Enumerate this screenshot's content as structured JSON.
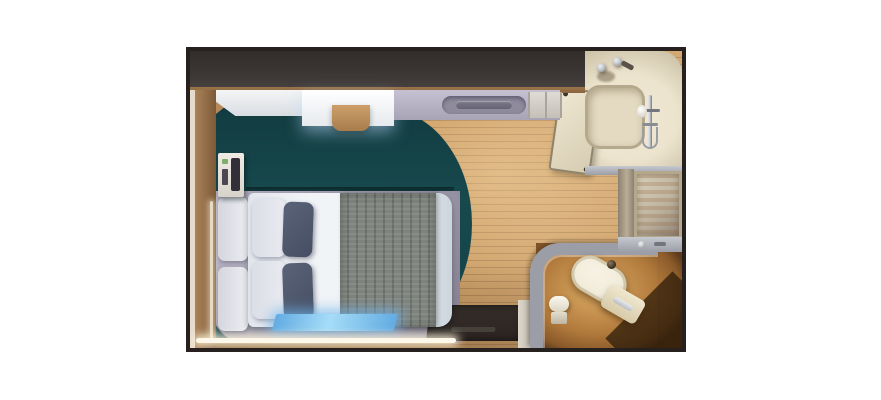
{
  "scene": {
    "type": "cruise-cabin-floorplan-render",
    "view": "top-down-3d",
    "rooms": [
      {
        "name": "bedroom",
        "items": [
          "overhead-shelf",
          "vanity-desk",
          "desk-stool",
          "overhead-cabinet",
          "wall-phone-panel",
          "teal-carpet",
          "bed-platform",
          "headboard",
          "bed-duvet",
          "bed-throw",
          "pillow-white-1",
          "pillow-white-2",
          "pillow-dark-1",
          "pillow-dark-2",
          "foot-bench",
          "led-strip-bottom",
          "led-strip-left"
        ]
      },
      {
        "name": "corridor",
        "items": [
          "wood-floor",
          "entrance-mat",
          "entry-wall"
        ]
      },
      {
        "name": "bathroom",
        "items": [
          "sink-faucets",
          "shower-tray",
          "shower-bar",
          "shower-knob",
          "bathroom-vanity-unit",
          "bath-ledge"
        ]
      },
      {
        "name": "wet-area",
        "items": [
          "vanity-divider",
          "mirror-cabinet",
          "vanity-counter"
        ]
      },
      {
        "name": "toilet-room",
        "items": [
          "toilet-room-wall",
          "toilet-seat",
          "toilet-tank",
          "flush-knob",
          "toilet-paper-roll",
          "toilet-paper-holder"
        ]
      }
    ]
  },
  "colors": {
    "background": "#ffffff",
    "frame": "#26211f",
    "top_wall": "#3b3533",
    "wood_mid": "#c9995f",
    "wood_line": "#a97c4b",
    "wall_wood": "#9a7448",
    "carpet_teal": "#17494d",
    "carpet_teal_dark": "#123c41",
    "platform": "#b6b1c3",
    "platform_dark": "#8e899b",
    "duvet": "#f1f4f7",
    "duvet_shadow": "#ccd5dd",
    "throw_gray": "#7f837d",
    "throw_stripe": "#6a6e68",
    "pillow_white": "#e9ebf1",
    "pillow_dark": "#525b71",
    "bench_blue": "#62abe2",
    "bench_blue_light": "#a5dcf8",
    "led_glow": "#fdf8ea",
    "bath_cream": "#ece3cd",
    "bath_cream_dark": "#c7bda2",
    "shower_tray": "#e3dac1",
    "shower_border": "#b4a98c",
    "chrome": "#c4c7cc",
    "chrome_dark": "#73767c",
    "partition_gray": "#9b9ea7",
    "partition_light": "#c6c8cf",
    "mirror_light": "#dcd2bd",
    "mirror_dark": "#93867a",
    "amber_light": "#dfae66",
    "amber_mid": "#b17a3c",
    "amber_dark": "#5d3a1b",
    "toilet_white": "#f2ecdb",
    "mat_dark": "#2b2421",
    "panel_white": "#e8e4dd"
  }
}
